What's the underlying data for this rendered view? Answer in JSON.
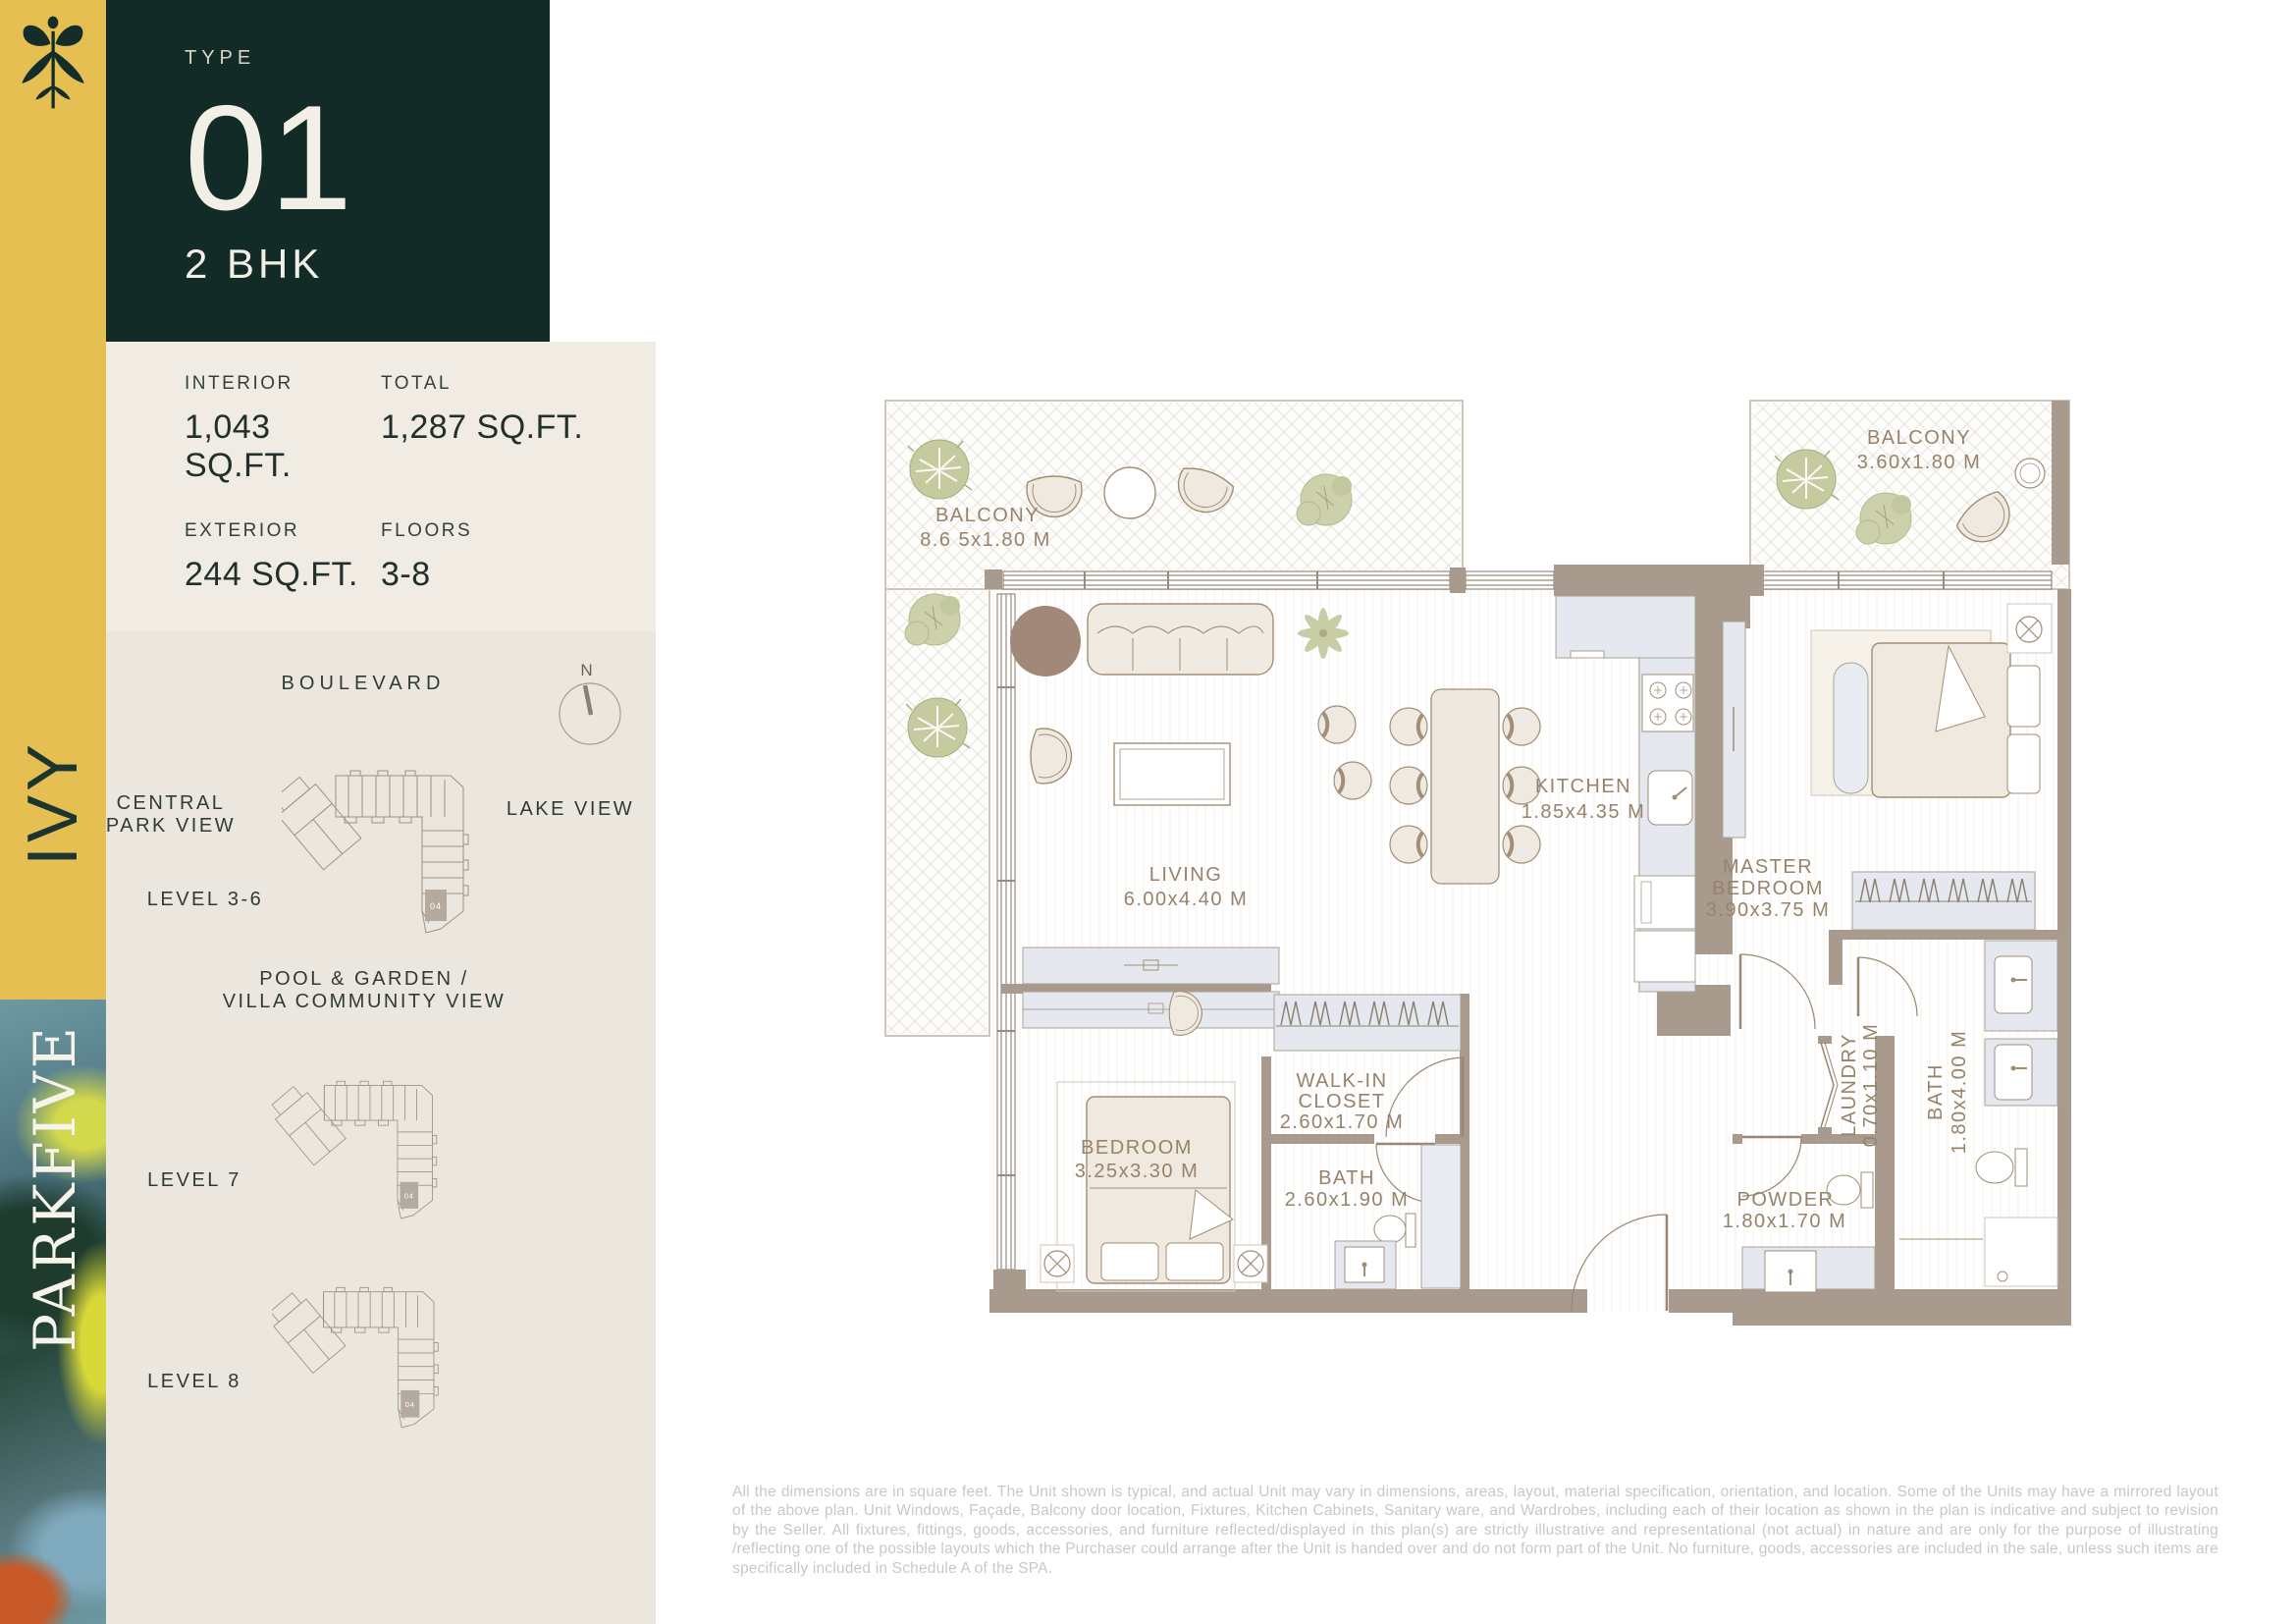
{
  "sidebar": {
    "building": "IVY",
    "project": "PARKFIVE"
  },
  "header": {
    "type_label": "TYPE",
    "type_number": "01",
    "unit_config": "2 BHK"
  },
  "stats": {
    "items": [
      {
        "label": "INTERIOR",
        "value": "1,043 SQ.FT."
      },
      {
        "label": "TOTAL",
        "value": "1,287 SQ.FT."
      },
      {
        "label": "EXTERIOR",
        "value": "244 SQ.FT."
      },
      {
        "label": "FLOORS",
        "value": "3-8"
      }
    ]
  },
  "siteplan": {
    "boulevard": "BOULEVARD",
    "north": "N",
    "central_park_line1": "CENTRAL",
    "central_park_line2": "PARK VIEW",
    "lake_view": "LAKE VIEW",
    "level_3_6": "LEVEL 3-6",
    "level_7": "LEVEL 7",
    "level_8": "LEVEL 8",
    "pool_line1": "POOL & GARDEN /",
    "pool_line2": "VILLA COMMUNITY VIEW",
    "unit_badge": "04"
  },
  "floorplan": {
    "balcony_left": {
      "name": "BALCONY",
      "dims": "8.6 5x1.80 M"
    },
    "balcony_right": {
      "name": "BALCONY",
      "dims": "3.60x1.80 M"
    },
    "living": {
      "name": "LIVING",
      "dims": "6.00x4.40 M"
    },
    "kitchen": {
      "name": "KITCHEN",
      "dims": "1.85x4.35 M"
    },
    "master_bedroom": {
      "line1": "MASTER",
      "line2": "BEDROOM",
      "dims": "3.90x3.75 M"
    },
    "walk_in_closet": {
      "line1": "WALK-IN",
      "line2": "CLOSET",
      "dims": "2.60x1.70 M"
    },
    "bedroom": {
      "name": "BEDROOM",
      "dims": "3.25x3.30 M"
    },
    "bath": {
      "name": "BATH",
      "dims": "2.60x1.90 M"
    },
    "master_bath": {
      "name": "BATH",
      "dims": "1.80x4.00 M"
    },
    "laundry": {
      "name": "LAUNDRY",
      "dims": "0.70x1.10 M"
    },
    "powder": {
      "name": "POWDER",
      "dims": "1.80x1.70 M"
    }
  },
  "disclaimer": "All the dimensions are in square feet. The Unit shown is typical, and actual Unit may vary in dimensions, areas, layout, material specification, orientation, and location. Some of the Units may have a mirrored layout of the above plan. Unit Windows, Façade, Balcony door location, Fixtures, Kitchen Cabinets, Sanitary ware, and Wardrobes, including each of their location as shown in the plan is indicative and subject to revision by the Seller. All fixtures, fittings, goods, accessories, and furniture reflected/displayed in this plan(s) are strictly illustrative and representational (not actual) in nature and are only for the purpose of illustrating /reflecting one of the possible layouts which the Purchaser could arrange after the Unit is handed over and do not form part of the Unit. No furniture, goods, accessories are included in the sale, unless such items are specifically included in Schedule A of the SPA."
}
